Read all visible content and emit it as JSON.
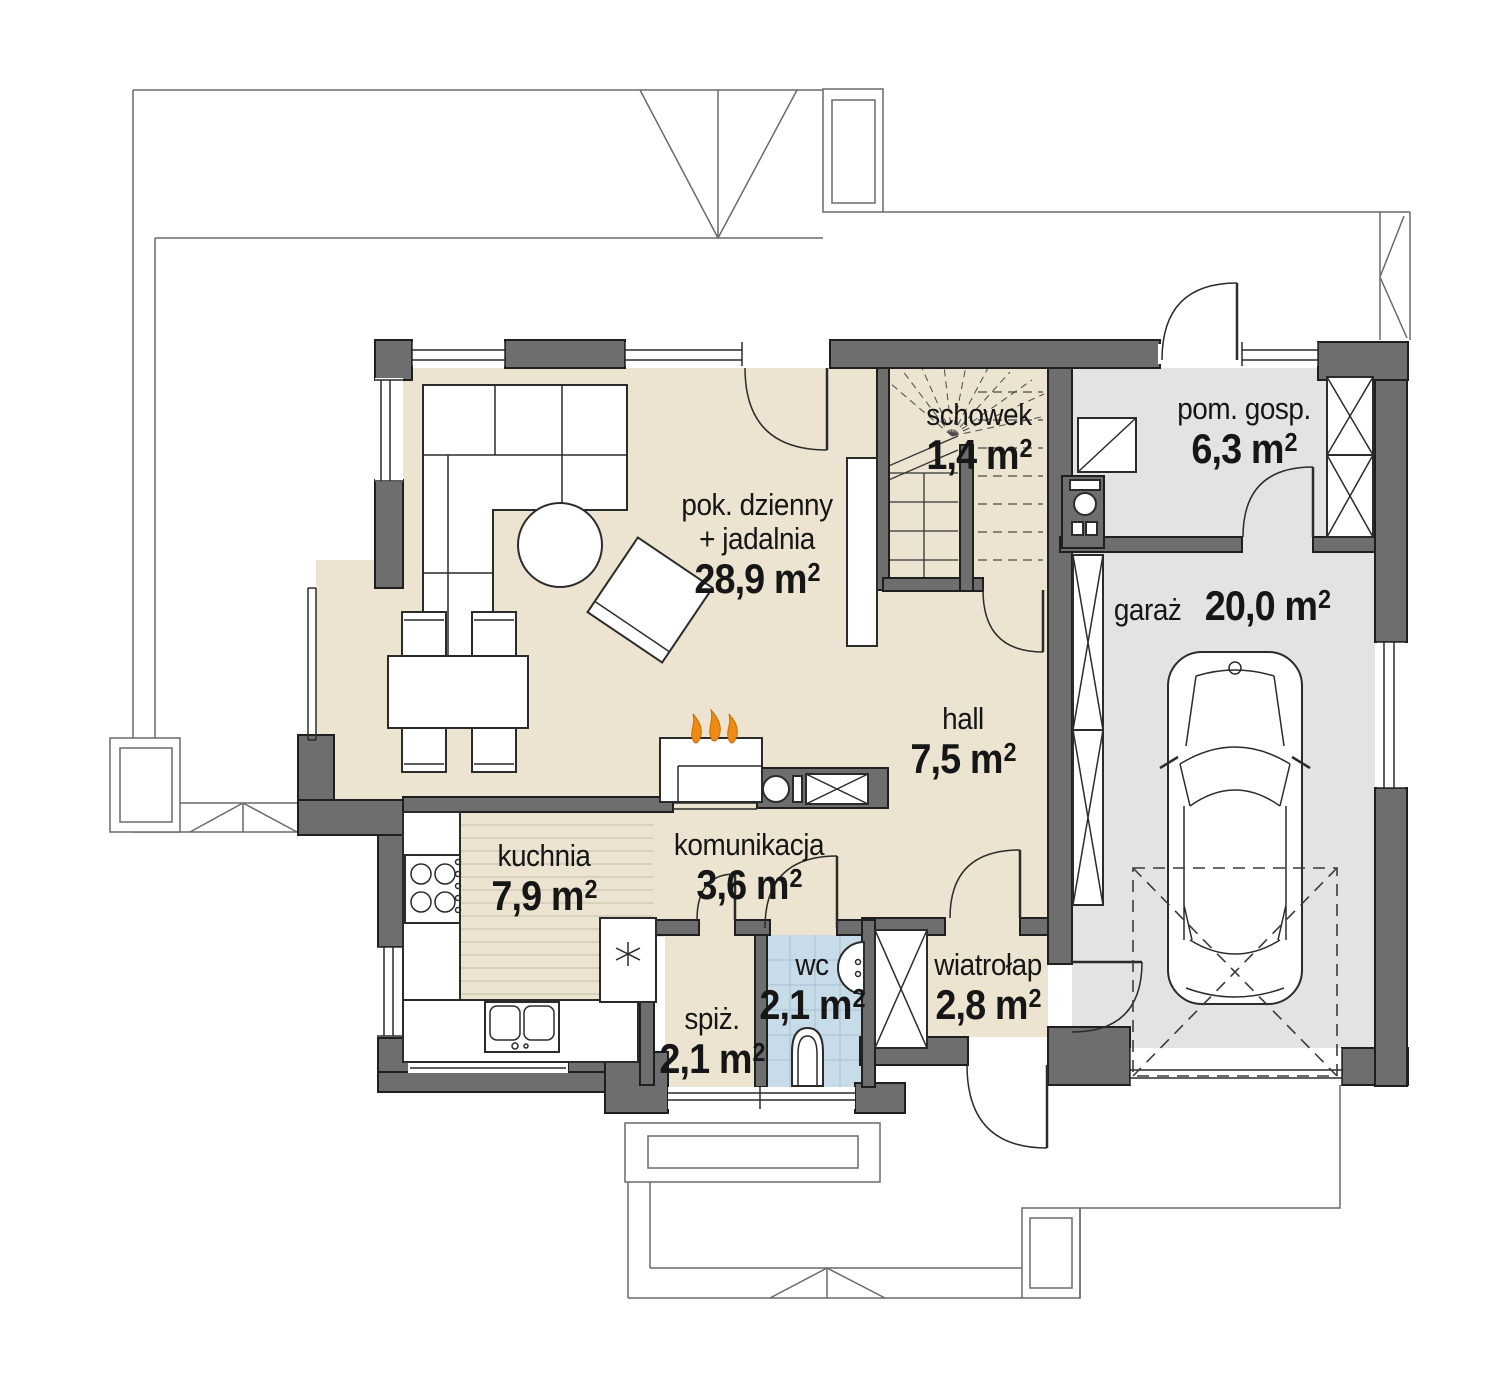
{
  "plan": {
    "rooms": [
      {
        "id": "living",
        "name": "pok. dzienny",
        "name2": "+ jadalnia",
        "area": "28,9 m²"
      },
      {
        "id": "schowek",
        "name": "schowek",
        "area": "1,4 m²"
      },
      {
        "id": "pom_gosp",
        "name": "pom. gosp.",
        "area": "6,3 m²"
      },
      {
        "id": "garaz",
        "name": "garaż",
        "area": "20,0 m²"
      },
      {
        "id": "hall",
        "name": "hall",
        "area": "7,5 m²"
      },
      {
        "id": "kuchnia",
        "name": "kuchnia",
        "area": "7,9 m²"
      },
      {
        "id": "komunikacja",
        "name": "komunikacja",
        "area": "3,6 m²"
      },
      {
        "id": "spiz",
        "name": "spiż.",
        "area": "2,1 m²"
      },
      {
        "id": "wc",
        "name": "wc",
        "area": "2,1 m²"
      },
      {
        "id": "wiatrolap",
        "name": "wiatrołap",
        "area": "2,8 m²"
      }
    ],
    "colors": {
      "wall": "#6e6e6e",
      "floor_beige": "#ece4d0",
      "floor_gray": "#e3e3e3",
      "tile_blue": "#c8dbe9",
      "tile_grid": "#a7bfd1",
      "wood_line": "#ccc4af",
      "flame_orange": "#ef8b13",
      "line_dark": "#1f1f1f"
    }
  }
}
